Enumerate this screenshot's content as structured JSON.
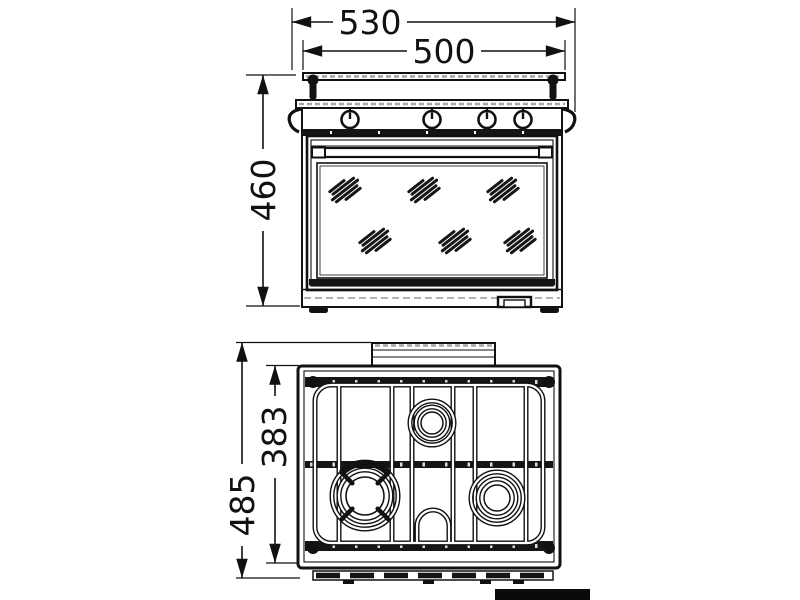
{
  "colors": {
    "ink": "#111111",
    "paper": "#ffffff"
  },
  "front_view": {
    "dim_overall_width": "530",
    "dim_cooktop_width": "500",
    "dim_height": "460"
  },
  "top_view": {
    "dim_grid_depth": "383",
    "dim_overall_depth": "485"
  }
}
